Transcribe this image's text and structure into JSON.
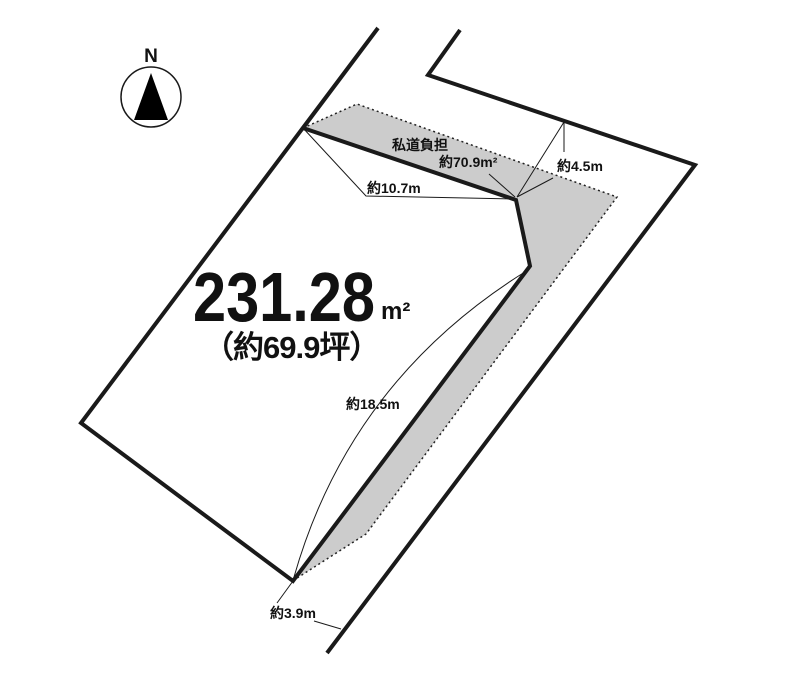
{
  "compass": {
    "north_label": "N"
  },
  "parcel": {
    "area_value": "231.28",
    "area_unit": "m²",
    "area_tsubo": "（約69.9坪）"
  },
  "private_road": {
    "label": "私道負担",
    "area": "約70.9m²"
  },
  "dimensions": {
    "road_width_top": "約4.5m",
    "frontage_upper": "約10.7m",
    "side_southeast": "約18.5m",
    "road_width_bottom": "約3.9m"
  },
  "colors": {
    "line": "#1a1a1a",
    "road_fill": "#cccccc",
    "background": "#ffffff"
  }
}
